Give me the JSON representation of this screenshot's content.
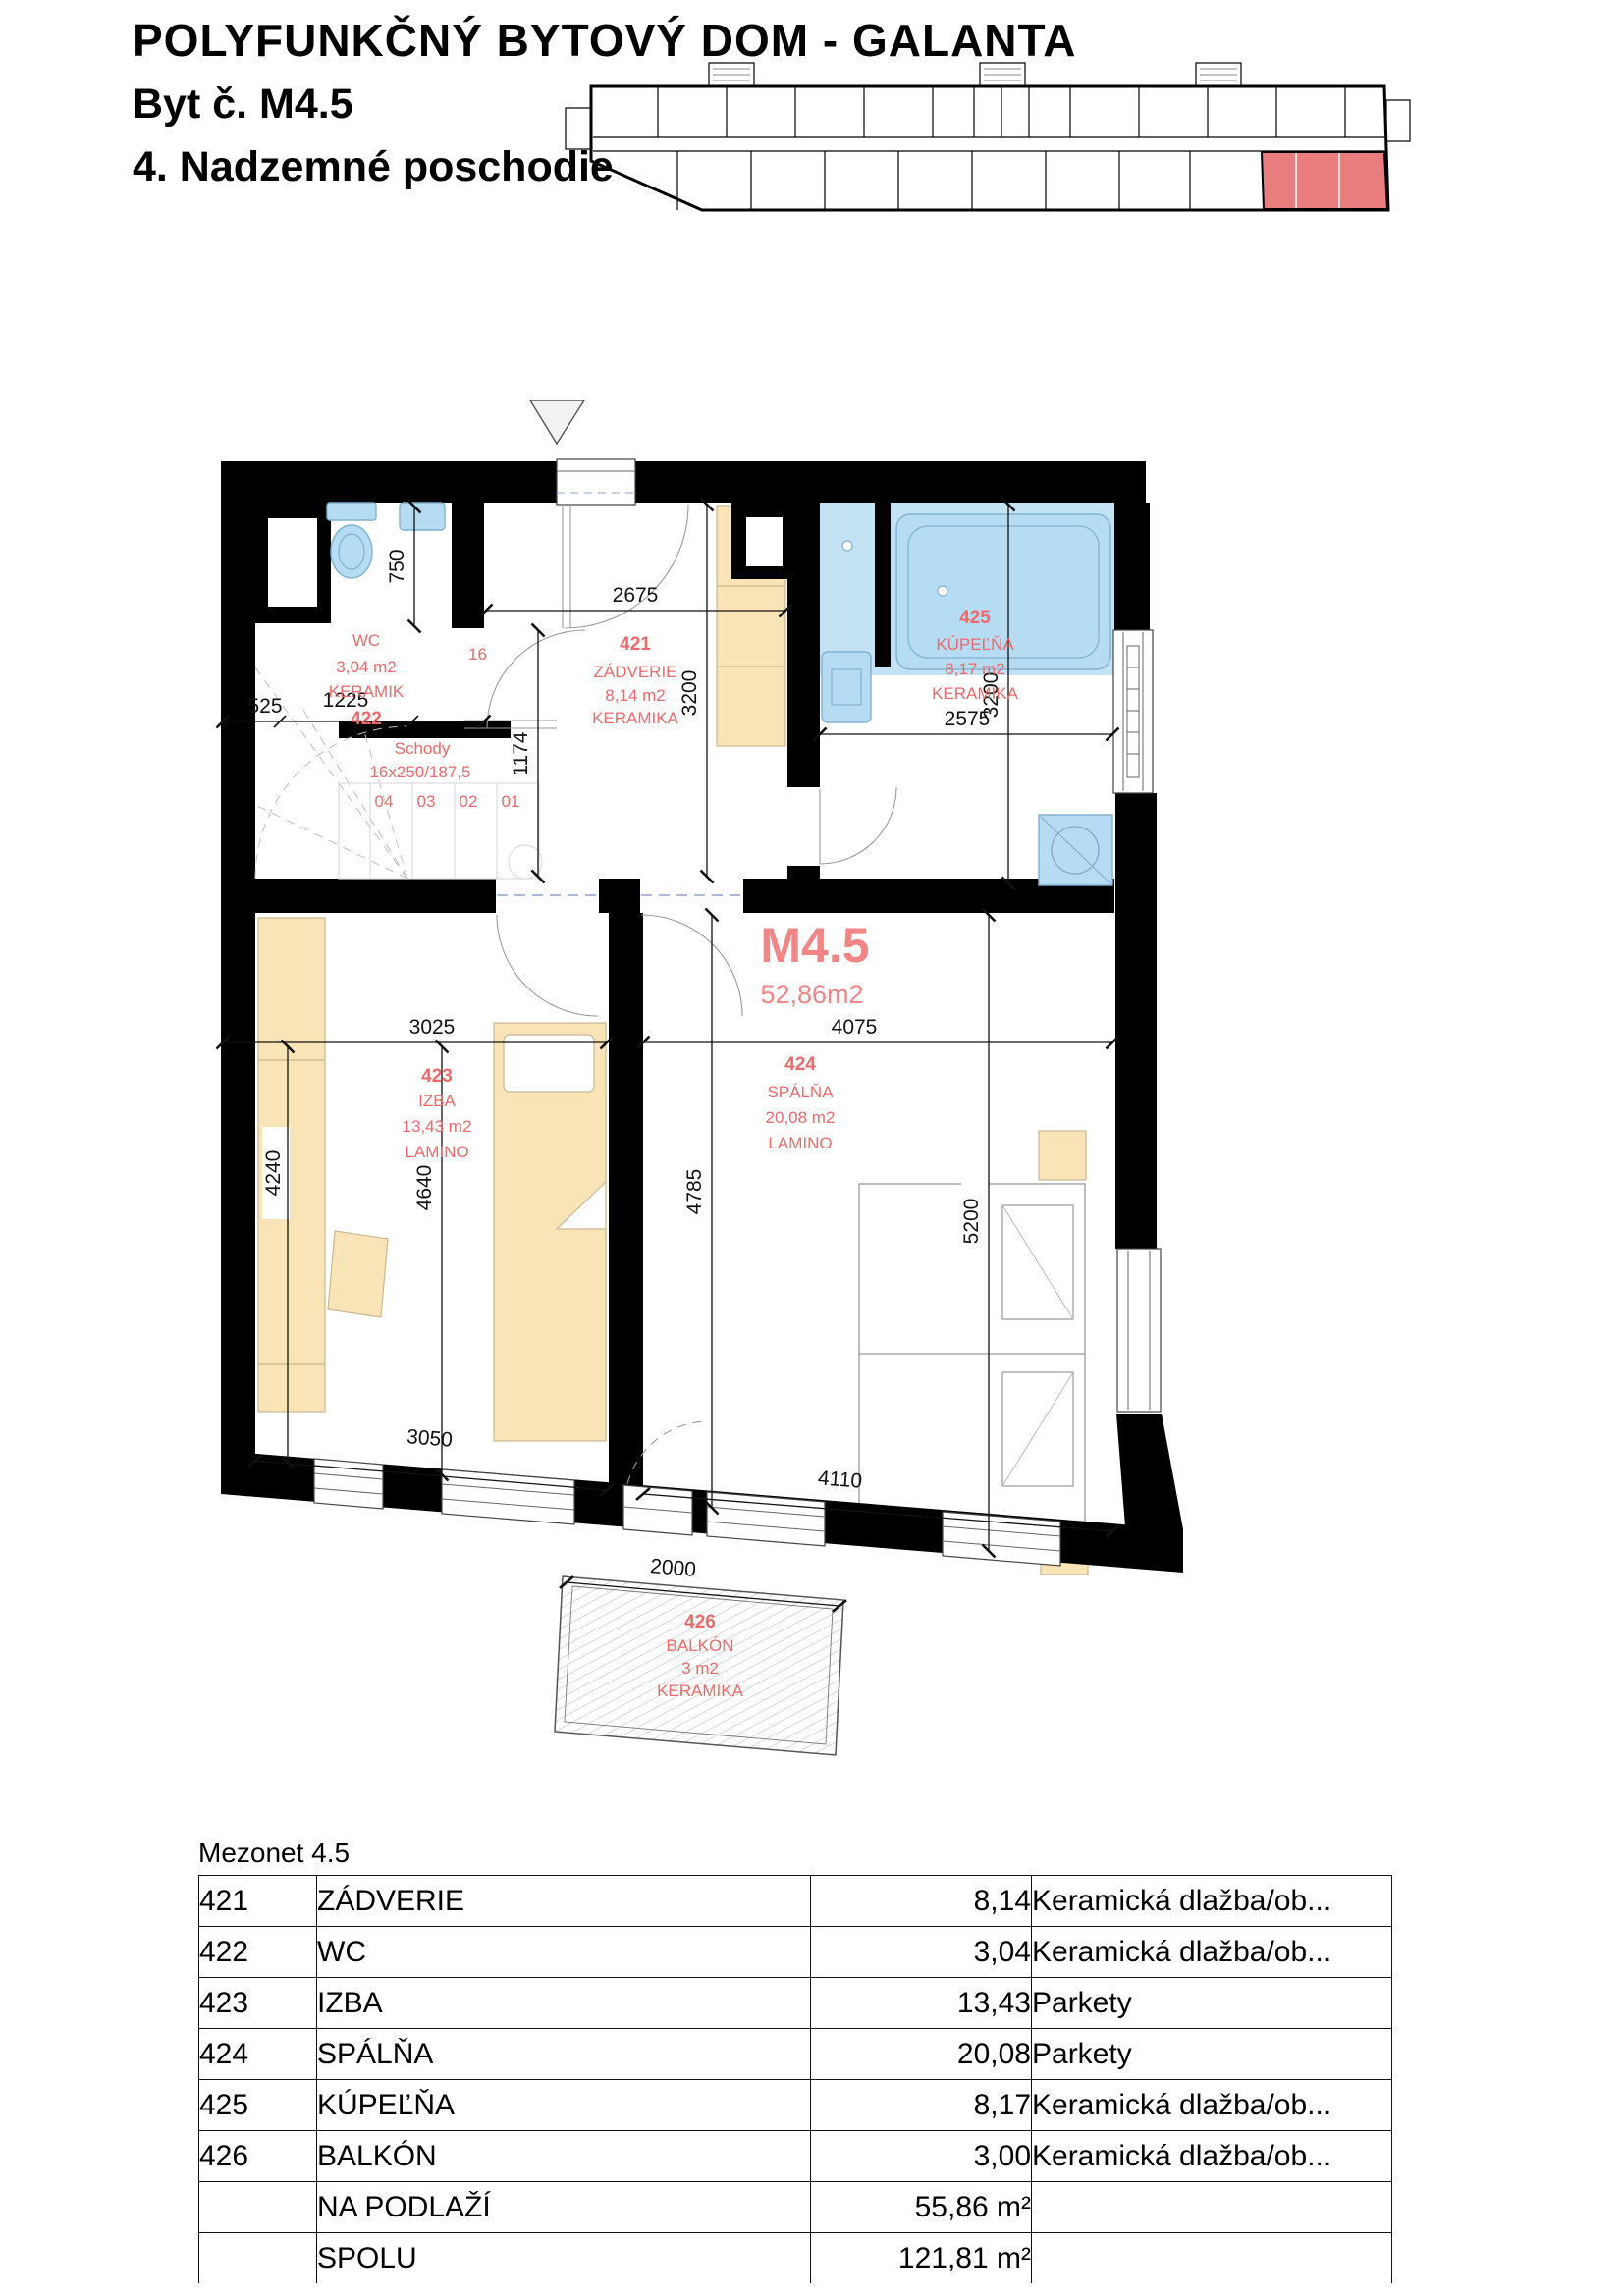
{
  "header": {
    "title": "POLYFUNKČNÝ BYTOVÝ DOM  -  GALANTA",
    "unit_line": "Byt č. M4.5",
    "floor_line": "4. Nadzemné poschodie"
  },
  "plan": {
    "unit_code": "M4.5",
    "unit_area": "52,86m2",
    "rooms": {
      "r421": {
        "num": "421",
        "name": "ZÁDVERIE",
        "area": "8,14 m2",
        "material": "KERAMIKA"
      },
      "r422": {
        "num": "422",
        "name": "WC",
        "area": "3,04 m2",
        "material": "KERAMIK"
      },
      "r423": {
        "num": "423",
        "name": "IZBA",
        "area": "13,43 m2",
        "material": "LAMINO"
      },
      "r424": {
        "num": "424",
        "name": "SPÁLŇA",
        "area": "20,08 m2",
        "material": "LAMINO"
      },
      "r425": {
        "num": "425",
        "name": "KÚPEĽŇA",
        "area": "8,17 m2",
        "material": "KERAMIKA"
      },
      "r426": {
        "num": "426",
        "name": "BALKÓN",
        "area": "3 m2",
        "material": "KERAMIKA"
      }
    },
    "stairs": {
      "label": "Schody",
      "spec": "16x250/187,5",
      "steps": [
        "04",
        "03",
        "02",
        "01"
      ],
      "top_step": "16"
    },
    "dims": {
      "d525": "525",
      "d1225": "1225",
      "d750": "750",
      "d1174": "1174",
      "d2675": "2675",
      "d3200a": "3200",
      "d3200b": "3200",
      "d2575": "2575",
      "d3025": "3025",
      "d4075": "4075",
      "d4240": "4240",
      "d4640": "4640",
      "d4785": "4785",
      "d5200": "5200",
      "d3050": "3050",
      "d4110": "4110",
      "d2000": "2000"
    }
  },
  "table": {
    "caption": "Mezonet 4.5",
    "rows": [
      {
        "num": "421",
        "name": "ZÁDVERIE",
        "area": "8,14",
        "material": "Keramická dlažba/ob..."
      },
      {
        "num": "422",
        "name": "WC",
        "area": "3,04",
        "material": "Keramická dlažba/ob..."
      },
      {
        "num": "423",
        "name": "IZBA",
        "area": "13,43",
        "material": "Parkety"
      },
      {
        "num": "424",
        "name": "SPÁLŇA",
        "area": "20,08",
        "material": "Parkety"
      },
      {
        "num": "425",
        "name": "KÚPEĽŇA",
        "area": "8,17",
        "material": "Keramická dlažba/ob..."
      },
      {
        "num": "426",
        "name": "BALKÓN",
        "area": "3,00",
        "material": "Keramická dlažba/ob..."
      }
    ],
    "summary": [
      {
        "label": "NA PODLAŽÍ",
        "value": "55,86 m²"
      },
      {
        "label": "SPOLU",
        "value": "121,81 m²"
      }
    ]
  },
  "colors": {
    "label_red": "#ee6a6a",
    "unit_red": "#f28585",
    "highlight_red": "#e97c7c",
    "fixture_blue": "#b5dcf2",
    "furniture_tan": "#f9e4b7"
  }
}
